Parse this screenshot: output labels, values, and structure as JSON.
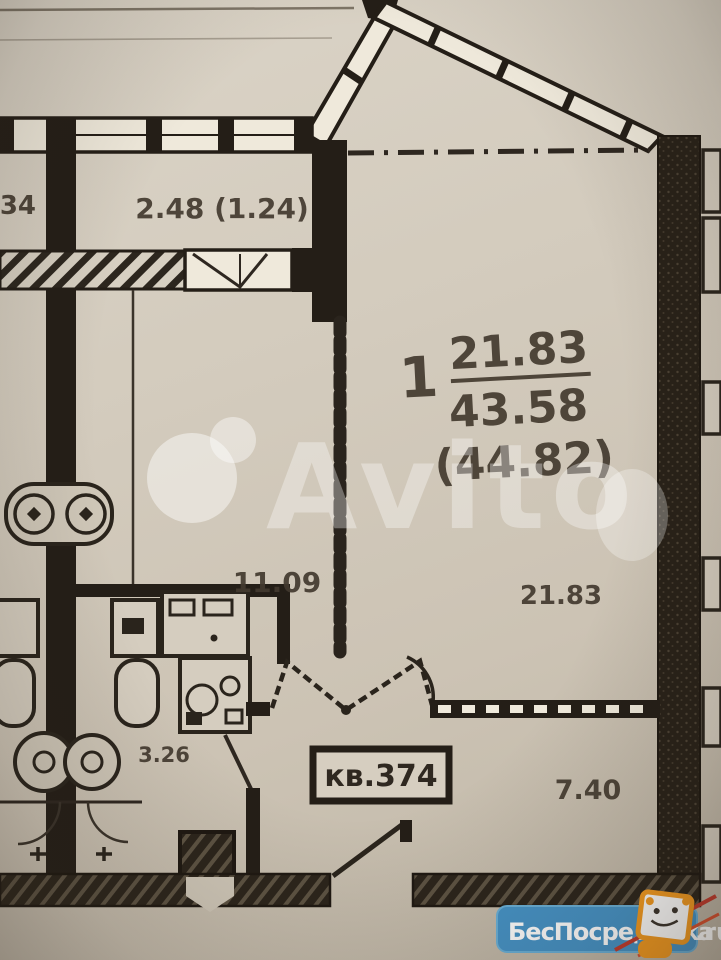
{
  "plan": {
    "apartment": {
      "rooms_count": "1",
      "living_area": "21.83",
      "total_area": "43.58",
      "area_with_balcony": "(44.82)",
      "number_label": "кв.374"
    },
    "dimensions": {
      "balcony": "2.48 (1.24)",
      "left_fragment": "34",
      "kitchen_room": "11.09",
      "living_room": "21.83",
      "bathroom": "3.26",
      "hall": "7.40"
    }
  },
  "watermarks": {
    "center_brand": "Avito",
    "badge": {
      "site": "БесПосредника",
      "tld": ".ru"
    }
  },
  "colors": {
    "paper": "#d2cabc",
    "wall": "#241e17",
    "ink": "#433a2f",
    "badge_blue": "#4593c7",
    "badge_orange": "#f59b1f"
  }
}
